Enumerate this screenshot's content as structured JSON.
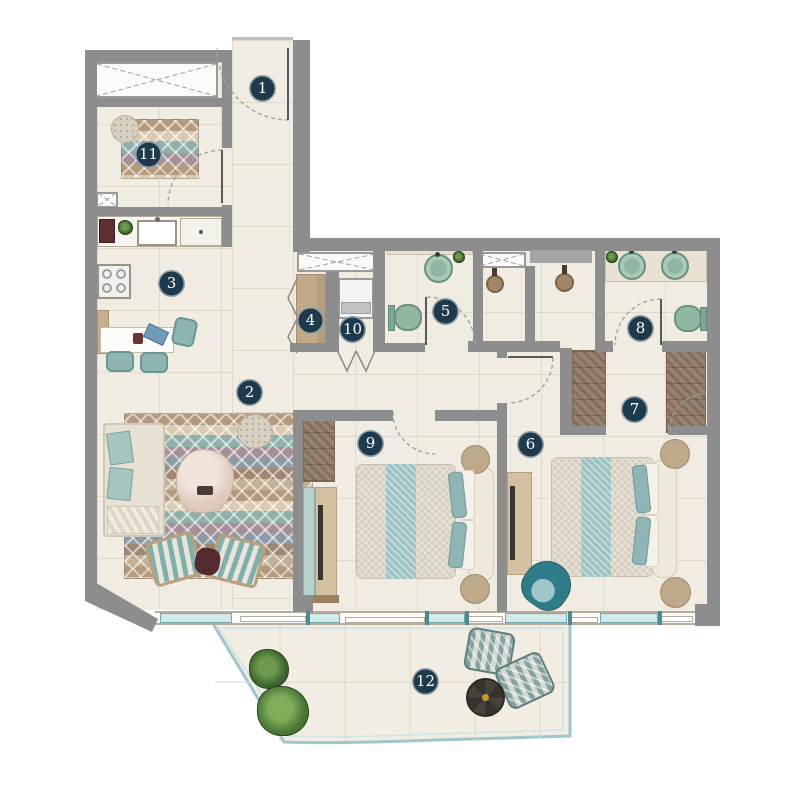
{
  "plan": {
    "type": "apartment-floor-plan",
    "colors": {
      "wall": "#8d8d8d",
      "floor": "#f1ece2",
      "badge": "#1e3a4d",
      "teal_furniture": "#8fb5b2",
      "fixture_green": "#8fb7a1",
      "wood_tan": "#c2a98a",
      "herringbone": "#98816d",
      "glass": "#d2e9e9"
    }
  },
  "rooms": [
    {
      "number": "1",
      "name": "entrance"
    },
    {
      "number": "2",
      "name": "living-dining"
    },
    {
      "number": "3",
      "name": "kitchen"
    },
    {
      "number": "4",
      "name": "hall-closet"
    },
    {
      "number": "5",
      "name": "bathroom"
    },
    {
      "number": "6",
      "name": "bedroom-1"
    },
    {
      "number": "7",
      "name": "walk-in-closet"
    },
    {
      "number": "8",
      "name": "bathroom-2"
    },
    {
      "number": "9",
      "name": "bedroom-2"
    },
    {
      "number": "10",
      "name": "laundry"
    },
    {
      "number": "11",
      "name": "study"
    },
    {
      "number": "12",
      "name": "balcony"
    }
  ]
}
